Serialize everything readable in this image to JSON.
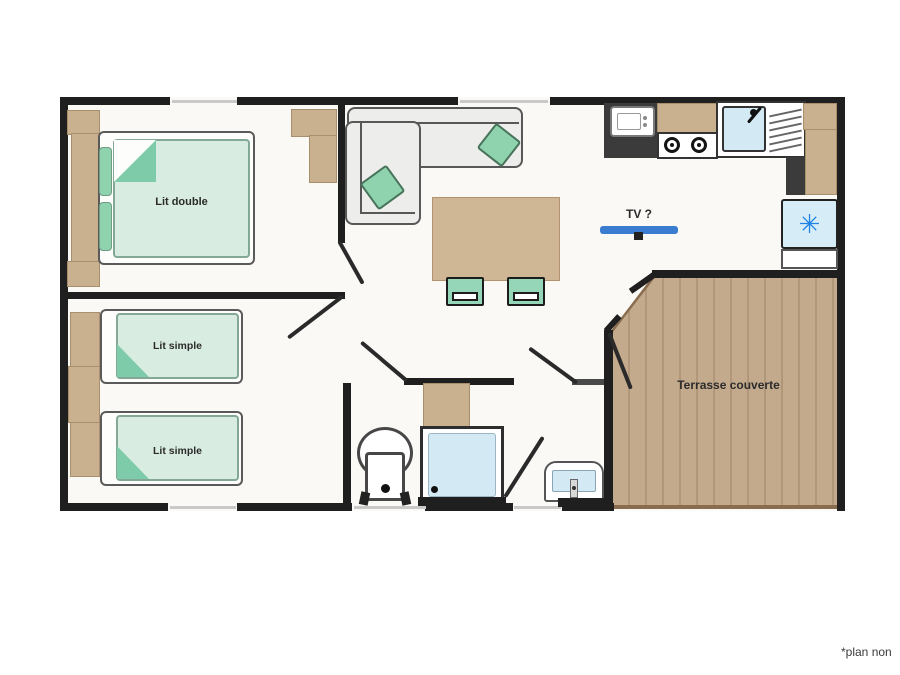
{
  "plan": {
    "rooms": {
      "bedroom_double": {
        "label": "Lit double"
      },
      "bedroom_twin": {
        "bed1_label": "Lit simple",
        "bed2_label": "Lit simple"
      },
      "living": {
        "tv_label": "TV ?"
      },
      "terrace": {
        "label": "Terrasse couverte"
      }
    },
    "footnote": "*plan non",
    "icons": {
      "fridge_snowflake": "✳"
    },
    "colors": {
      "wall": "#1f1f1f",
      "tan": "#c9b18f",
      "terrace_floor": "#c3aa8c",
      "terrace_stripe": "#b0977a",
      "terrace_border": "#8a6d4f",
      "mint_light": "#d9ece1",
      "mint": "#8fd3ae",
      "blue_light": "#d3e9f3",
      "tv_blue": "#3a7cd0",
      "asterisk_blue": "#1e82e8"
    }
  }
}
